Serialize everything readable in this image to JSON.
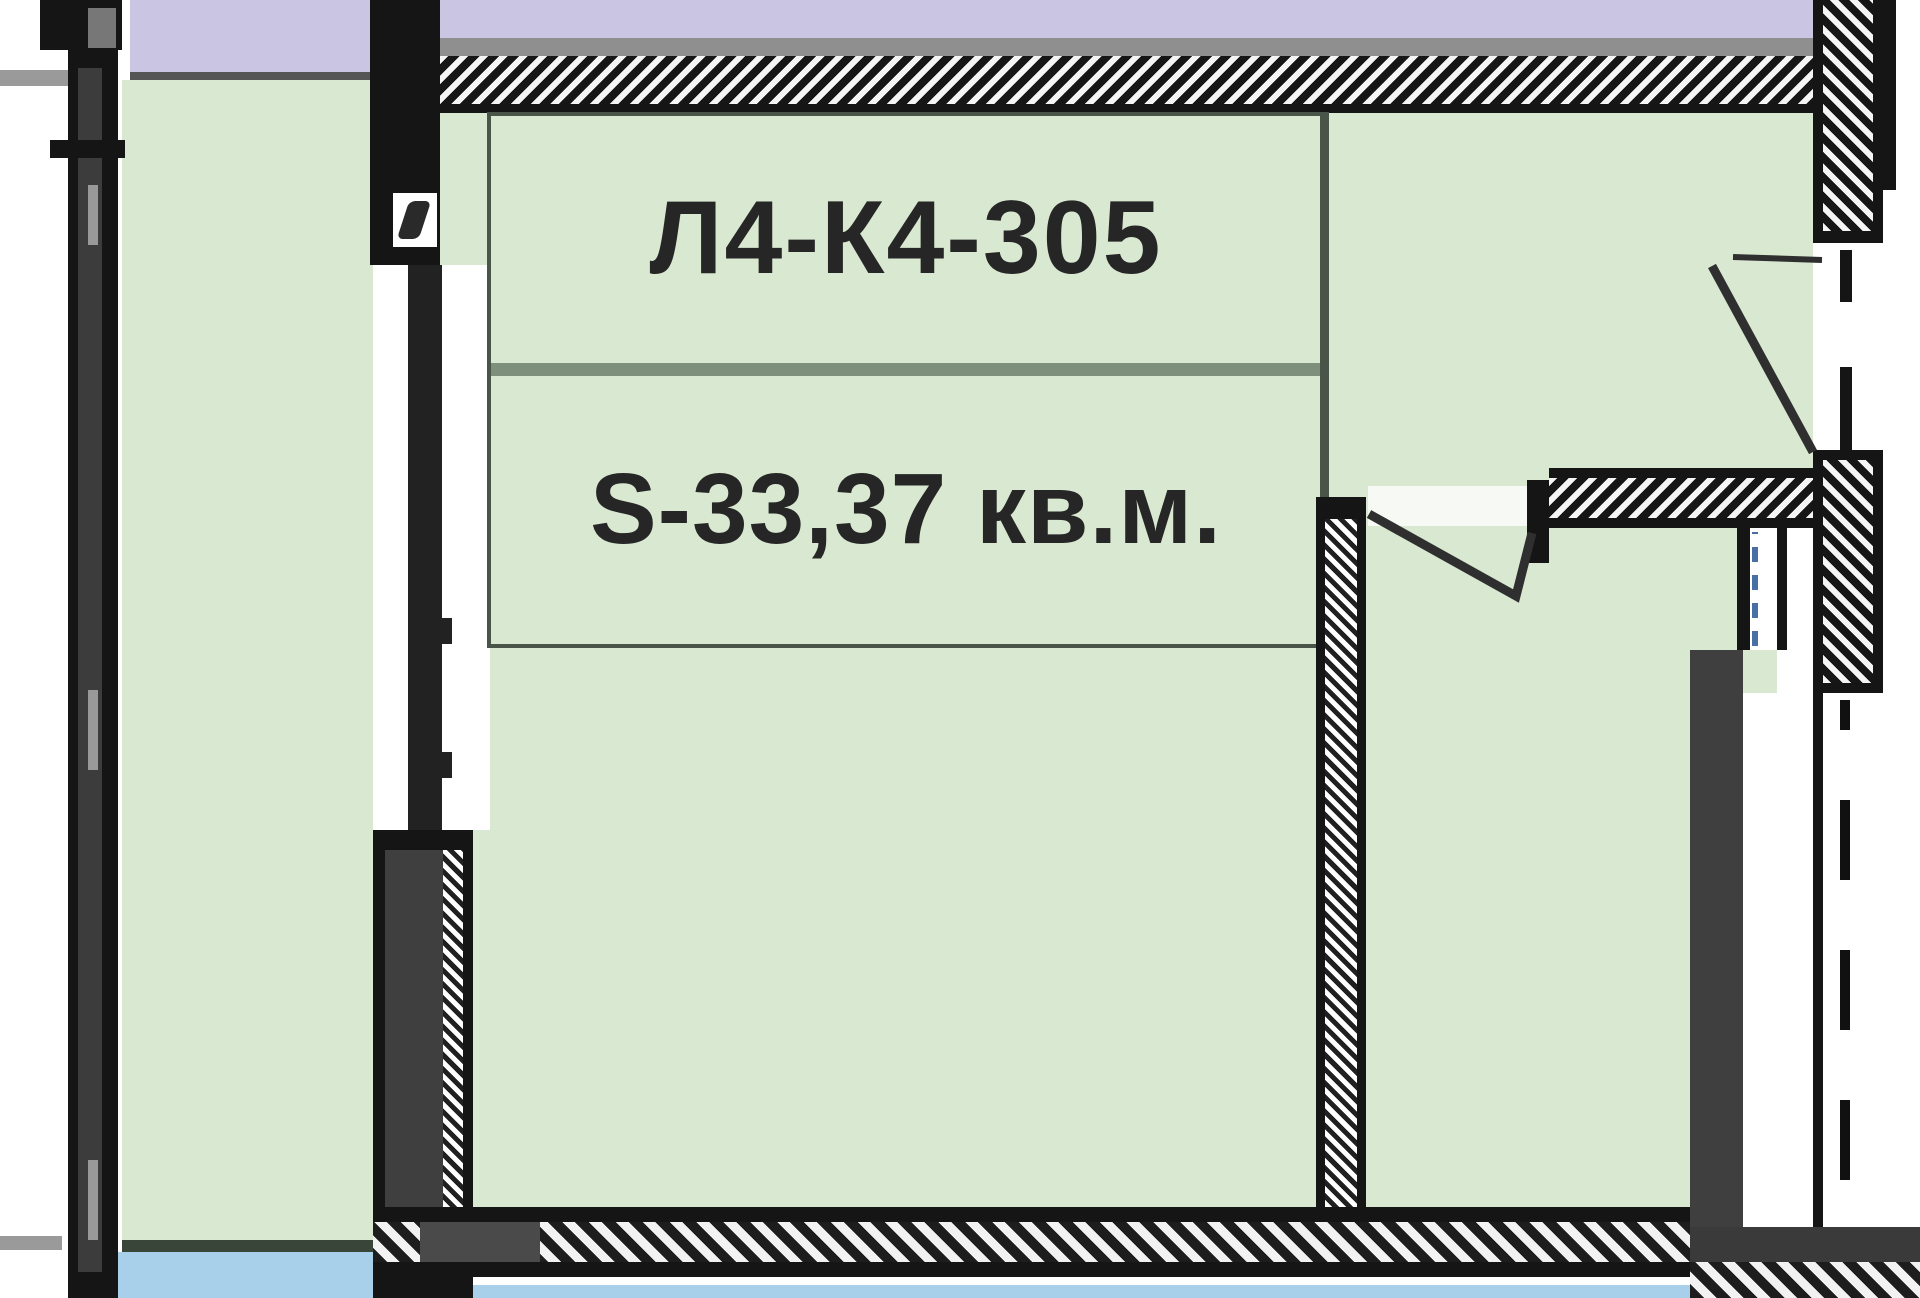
{
  "plan": {
    "unit_label": "Л4-К4-305",
    "area_label": "S-33,37 кв.м."
  },
  "colors": {
    "apartment_room_fill": "#d9e8d1",
    "neighbor_area_fill": "#c9c5e2",
    "bottom_area_fill": "#a8d0ea",
    "wall_black": "#151515",
    "wall_gray": "#3f3f3f",
    "label_text": "#262626",
    "label_divider": "#7e8f7c",
    "shaft_dash_blue": "#4a6fa5"
  }
}
